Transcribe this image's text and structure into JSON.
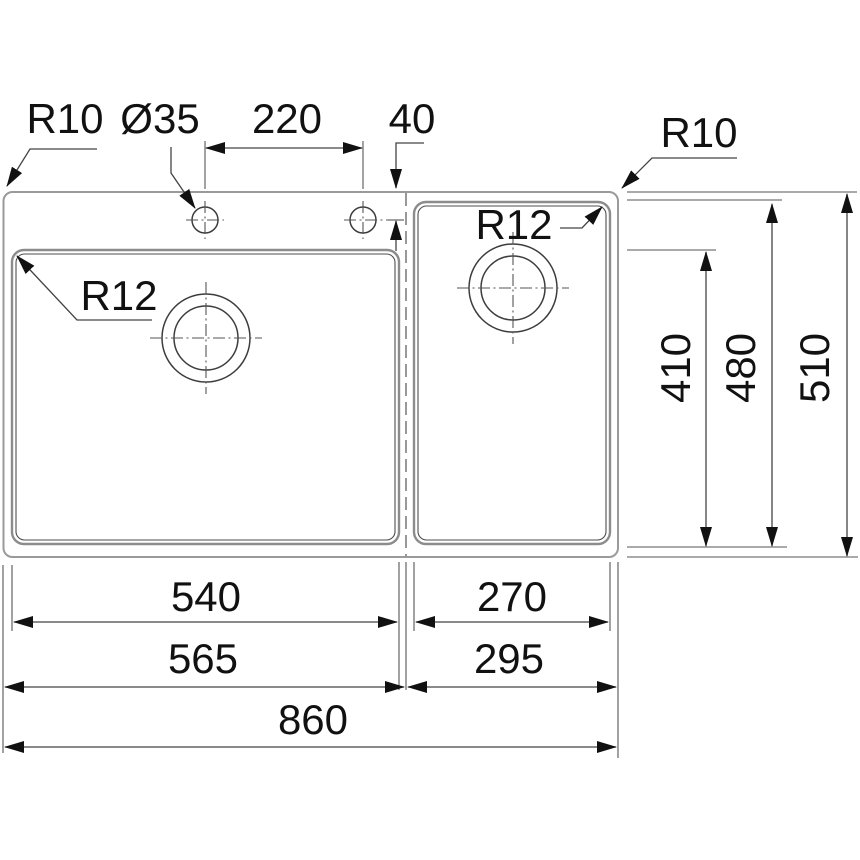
{
  "diagram": {
    "type": "technical-drawing",
    "subject": "Double-bowl kitchen sink, top view with installation dimensions",
    "units": "mm",
    "colors": {
      "background": "#ffffff",
      "line": "#444444",
      "outline_gray": "#8c8c8c",
      "text": "#111111"
    },
    "labels": {
      "outer_corner_radius_left": "R10",
      "tap_hole_diameter": "Ø35",
      "tap_hole_spacing": "220",
      "tap_hole_offset": "40",
      "outer_corner_radius_right": "R10",
      "left_bowl_corner_radius": "R12",
      "right_bowl_corner_radius": "R12",
      "left_bowl_depth": "410",
      "right_bowl_depth": "480",
      "overall_depth": "510",
      "left_bowl_width": "540",
      "right_bowl_width": "270",
      "left_section_width": "565",
      "right_section_width": "295",
      "overall_width": "860"
    }
  }
}
